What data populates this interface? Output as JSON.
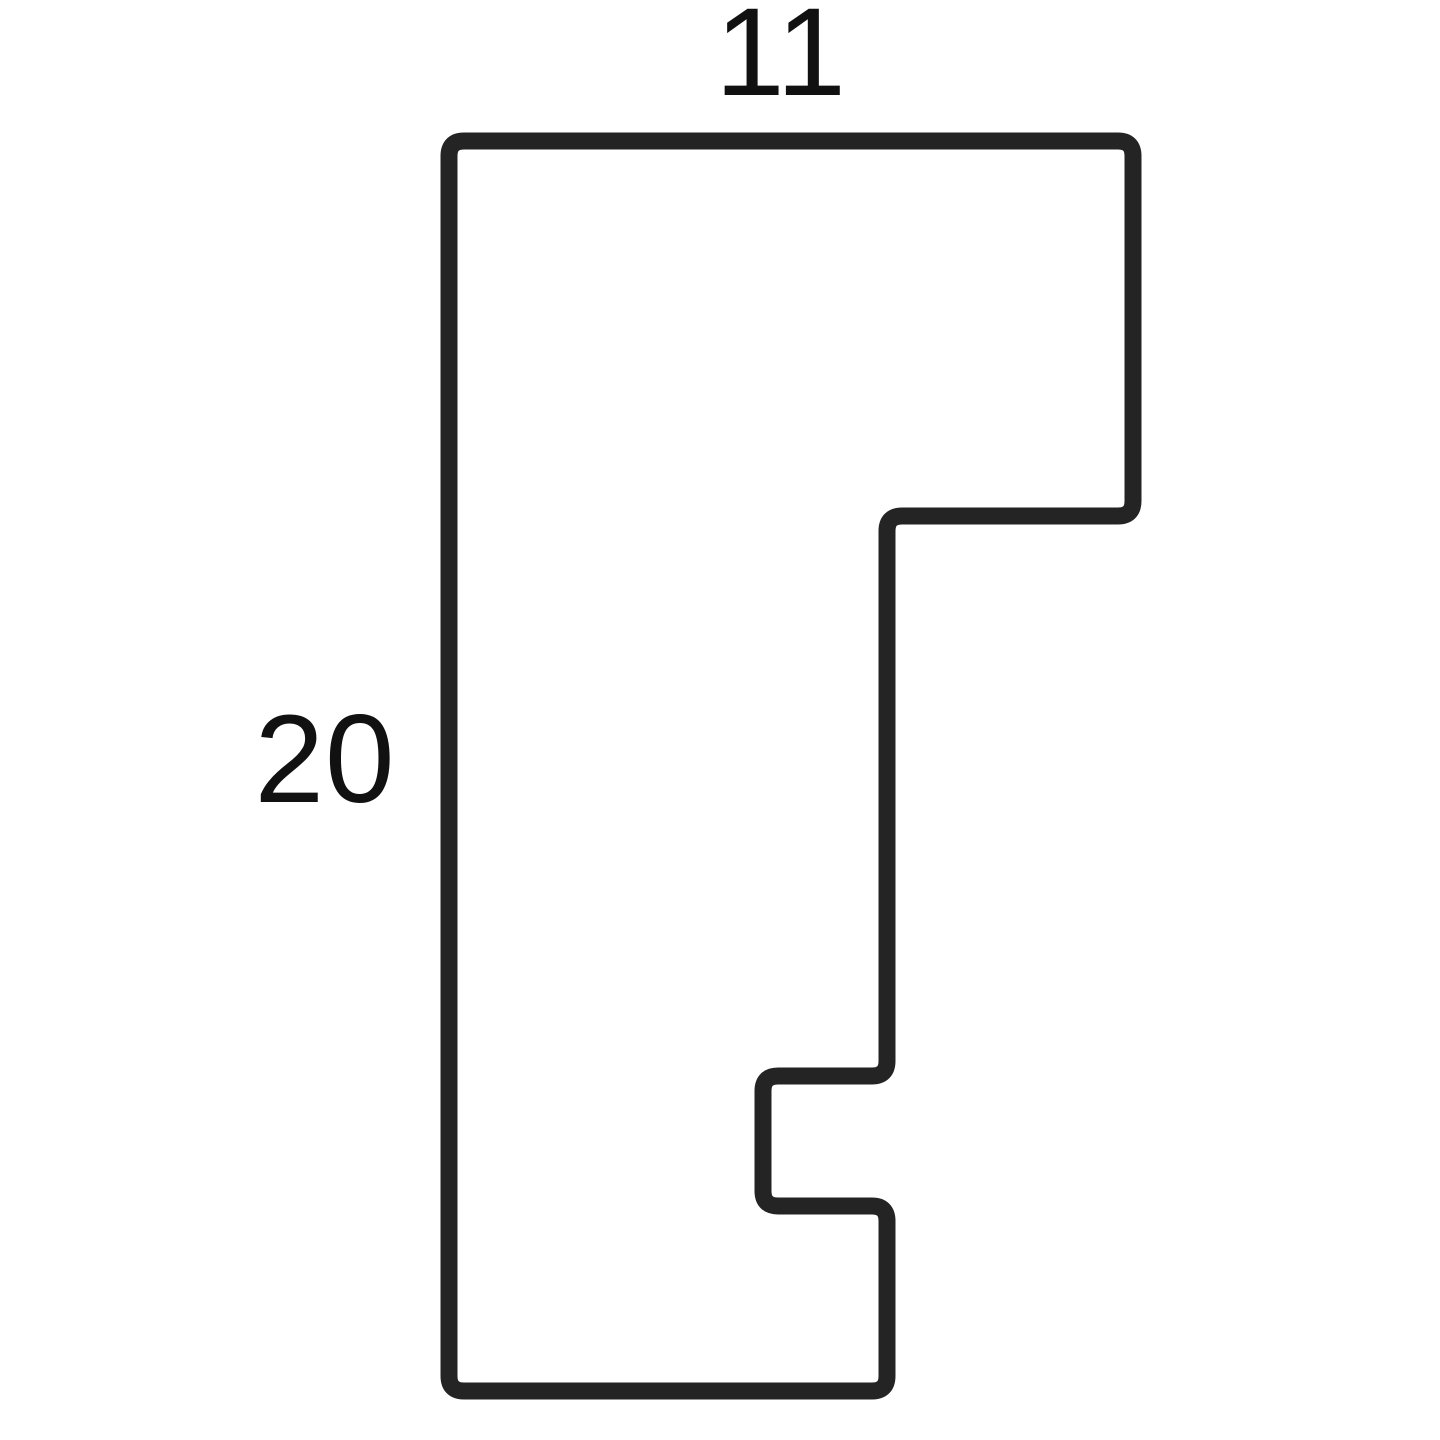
{
  "diagram": {
    "type": "profile-cross-section",
    "description": "Moulding profile cross-section outline drawing",
    "background_color": "#ffffff",
    "outline": {
      "stroke_color": "#242424",
      "stroke_width": 17,
      "corner_radius": 15,
      "fill": "none",
      "profile_points": [
        [
          449,
          141
        ],
        [
          1133,
          141
        ],
        [
          1133,
          516
        ],
        [
          887,
          516
        ],
        [
          887,
          1076
        ],
        [
          763,
          1076
        ],
        [
          763,
          1206
        ],
        [
          887,
          1206
        ],
        [
          887,
          1391
        ],
        [
          449,
          1391
        ]
      ]
    },
    "dimensions": {
      "width_label": "11",
      "height_label": "20",
      "label_color": "#111111",
      "width_label_pos": {
        "x": 781,
        "y": 95
      },
      "height_label_pos": {
        "x": 325,
        "y": 802
      }
    }
  }
}
